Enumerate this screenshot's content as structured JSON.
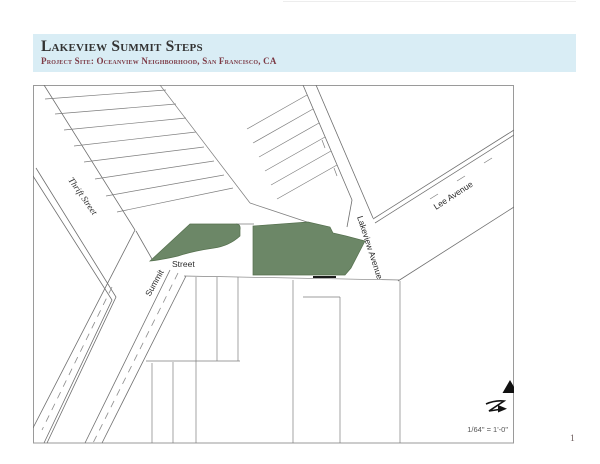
{
  "header": {
    "title": "Lakeview Summit Steps",
    "subtitle": "Project Site: Oceanview Neighborhood, San Francisco, CA",
    "bg_color": "#d9edf5",
    "title_color": "#333333",
    "subtitle_color": "#7c3a45"
  },
  "map": {
    "labels": {
      "thrift_street": "Thrift Street",
      "summit_diagonal": "Summit",
      "summit_horizontal": "Street",
      "lakeview_avenue": "Lakeview Avenue",
      "lee_avenue": "Lee Avenue"
    },
    "site_color": "#6c8767",
    "site_outline_color": "#55704e",
    "scale_note": "1/64\" = 1'-0\"",
    "north_arrow_icon": "north-arrow",
    "match_line_icon": "z-arrow-symbol"
  },
  "page": {
    "number": "1"
  }
}
